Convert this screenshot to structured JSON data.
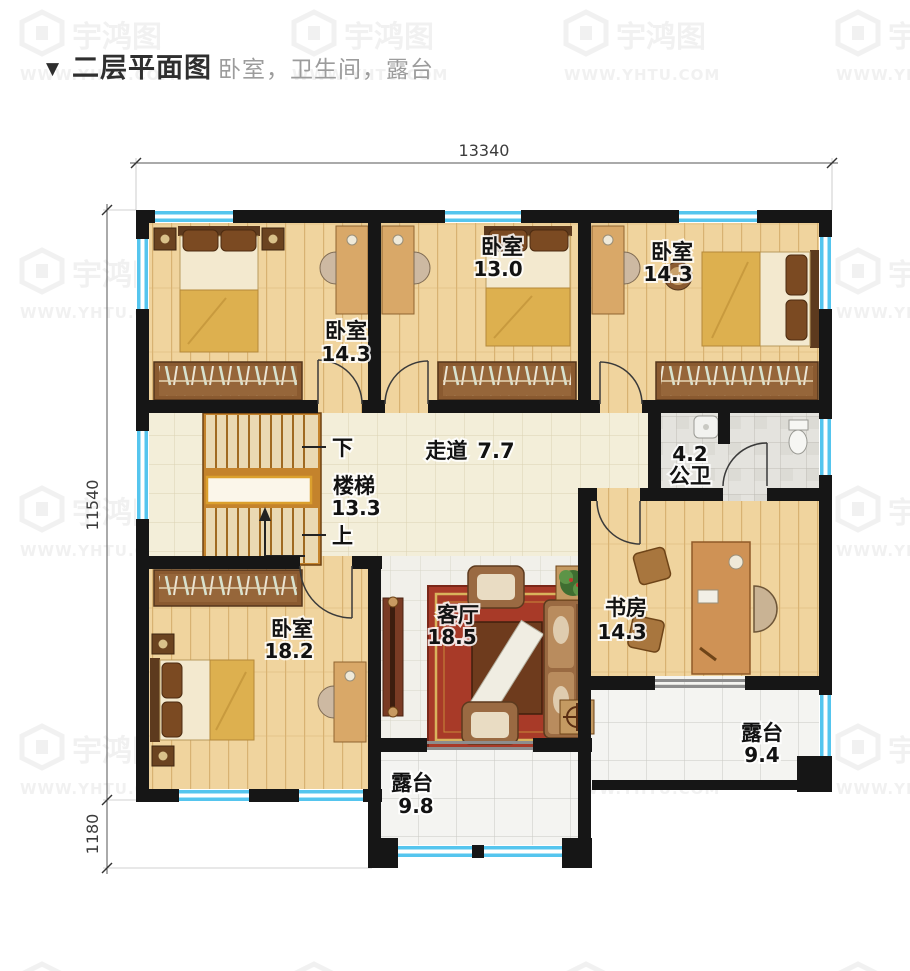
{
  "page": {
    "title_marker": "▼",
    "title": "二层平面图",
    "subtitle": "卧室，卫生间，露台"
  },
  "watermark": {
    "brand": "宇鸿图",
    "url": "WWW.YHTU.COM"
  },
  "dimensions": {
    "top_width": "13340",
    "left_height": "11540",
    "left_bottom": "1180"
  },
  "rooms": {
    "bedroom_top_left": {
      "name": "卧室",
      "area": "14.3"
    },
    "bedroom_top_middle": {
      "name": "卧室",
      "area": "13.0"
    },
    "bedroom_top_right": {
      "name": "卧室",
      "area": "14.3"
    },
    "corridor": {
      "name": "走道",
      "area": "7.7"
    },
    "bathroom": {
      "name": "公卫",
      "area": "4.2"
    },
    "stairs": {
      "name": "楼梯",
      "area": "13.3",
      "down_label": "下",
      "up_label": "上"
    },
    "bedroom_bottom_left": {
      "name": "卧室",
      "area": "18.2"
    },
    "living_room": {
      "name": "客厅",
      "area": "18.5"
    },
    "study": {
      "name": "书房",
      "area": "14.3"
    },
    "terrace_right": {
      "name": "露台",
      "area": "9.4"
    },
    "terrace_bottom": {
      "name": "露台",
      "area": "9.8"
    }
  },
  "colors": {
    "wall": "#161616",
    "window": "#55c5ee",
    "wood_floor": "#f0d49e",
    "corridor_floor": "#f3eed9",
    "tile_floor": "#f4f4f1",
    "bath_tile": "#e4e3de",
    "carpet": "#a83a28",
    "stair": "#c4832c",
    "label_text": "#121212",
    "subtitle_text": "#9c9c9c"
  }
}
